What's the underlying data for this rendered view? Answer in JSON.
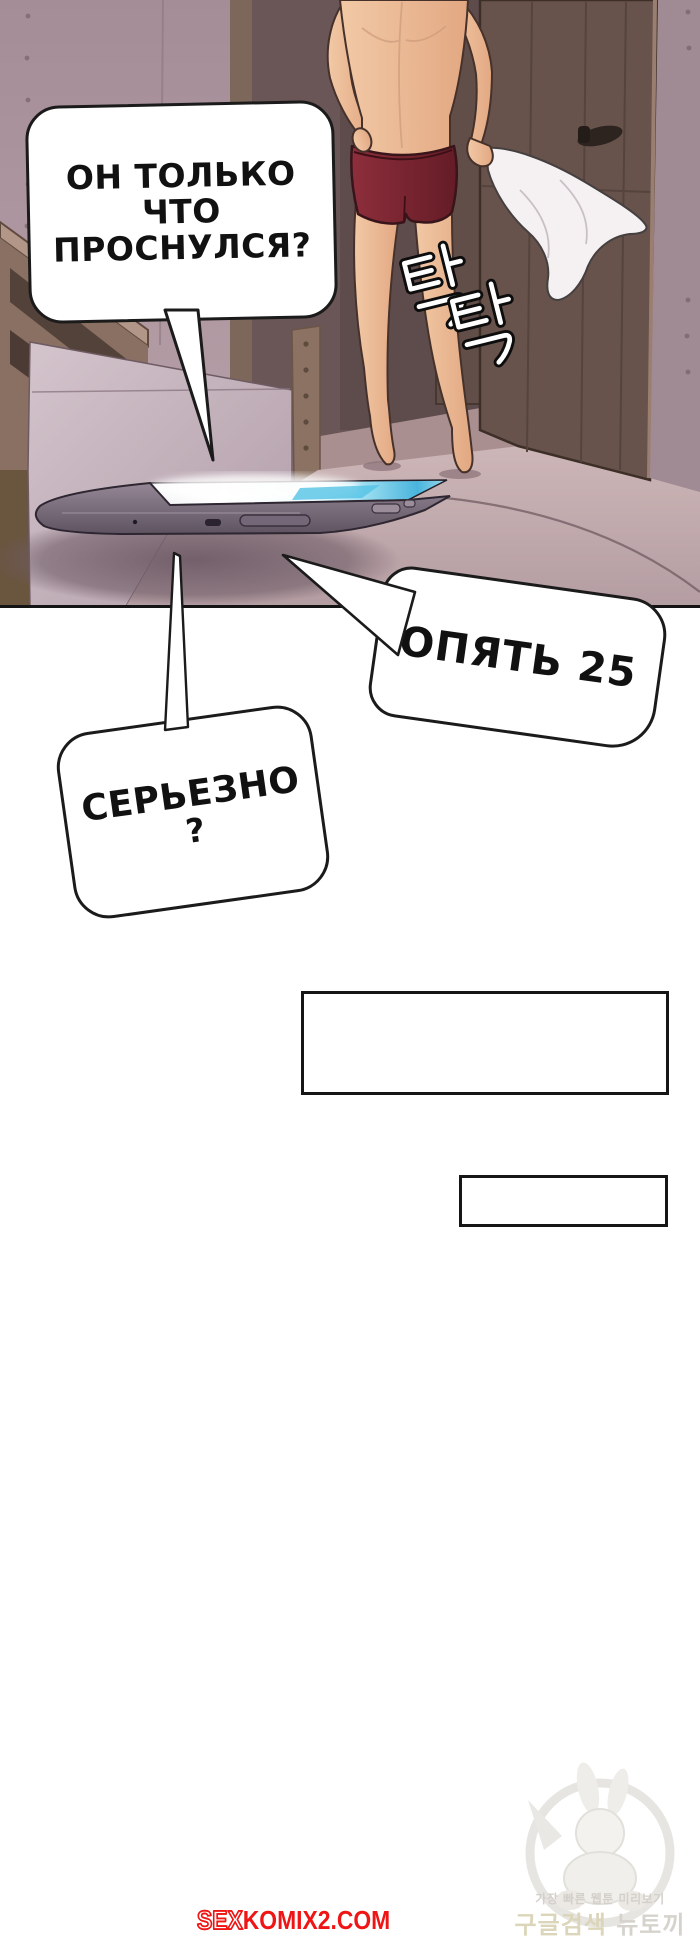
{
  "speech": {
    "b1": [
      "ОН ТОЛЬКО",
      "ЧТО",
      "ПРОСНУЛСЯ?"
    ],
    "b2": "ОПЯТЬ 25",
    "b3": [
      "СЕРЬЕЗНО",
      "?"
    ]
  },
  "sfx": {
    "doorway": "탁 탁"
  },
  "watermark": {
    "tagline": "가장 빠른 웹툰 미리보기",
    "search": "구글검색",
    "brand": "뉴토끼"
  },
  "site": {
    "prefix": "SEX",
    "suffix": "KOMIX2.COM"
  },
  "colors": {
    "ink": "#1b1b1b",
    "site_red": "#ef1515",
    "wall": "#a58d98",
    "shorts": "#7c2531",
    "skin": "#eec19e",
    "screen_glow": "#bfeaf5"
  }
}
